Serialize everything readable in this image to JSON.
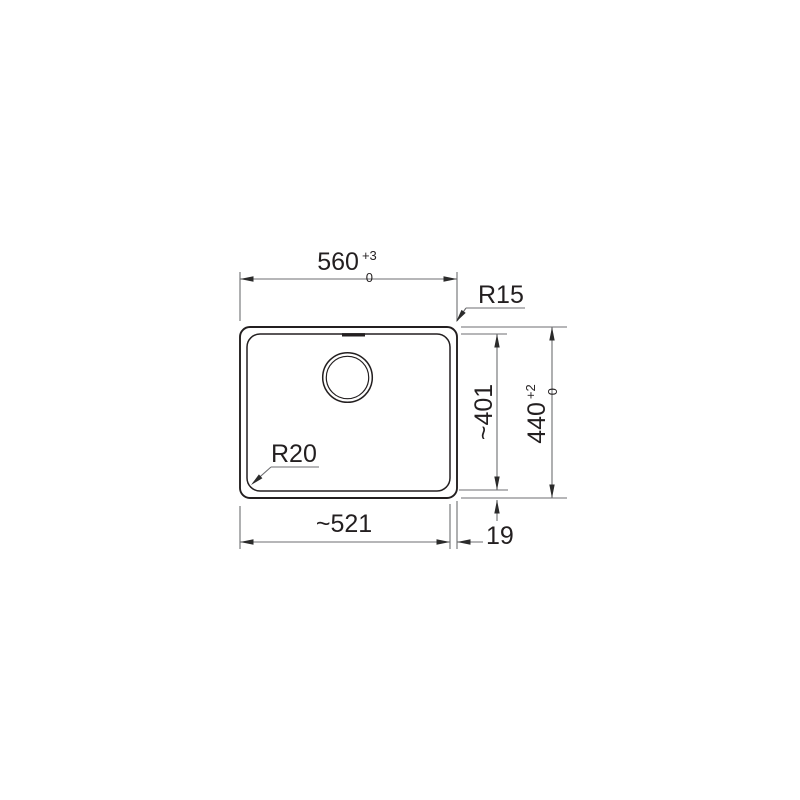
{
  "dimensions": {
    "outer_width": {
      "value": "560",
      "tol_upper": "+3",
      "tol_lower": "0"
    },
    "outer_height": {
      "value": "440",
      "tol_upper": "+2",
      "tol_lower": "0"
    },
    "inner_width": {
      "value": "~521"
    },
    "inner_height": {
      "value": "~401"
    },
    "rim_offset": {
      "value": "19"
    },
    "outer_corner_radius": {
      "value": "R15"
    },
    "inner_corner_radius": {
      "value": "R20"
    }
  },
  "colors": {
    "background": "#ffffff",
    "outline": "#231f20",
    "dimension_lines": "#6d6e71",
    "text": "#231f20"
  }
}
